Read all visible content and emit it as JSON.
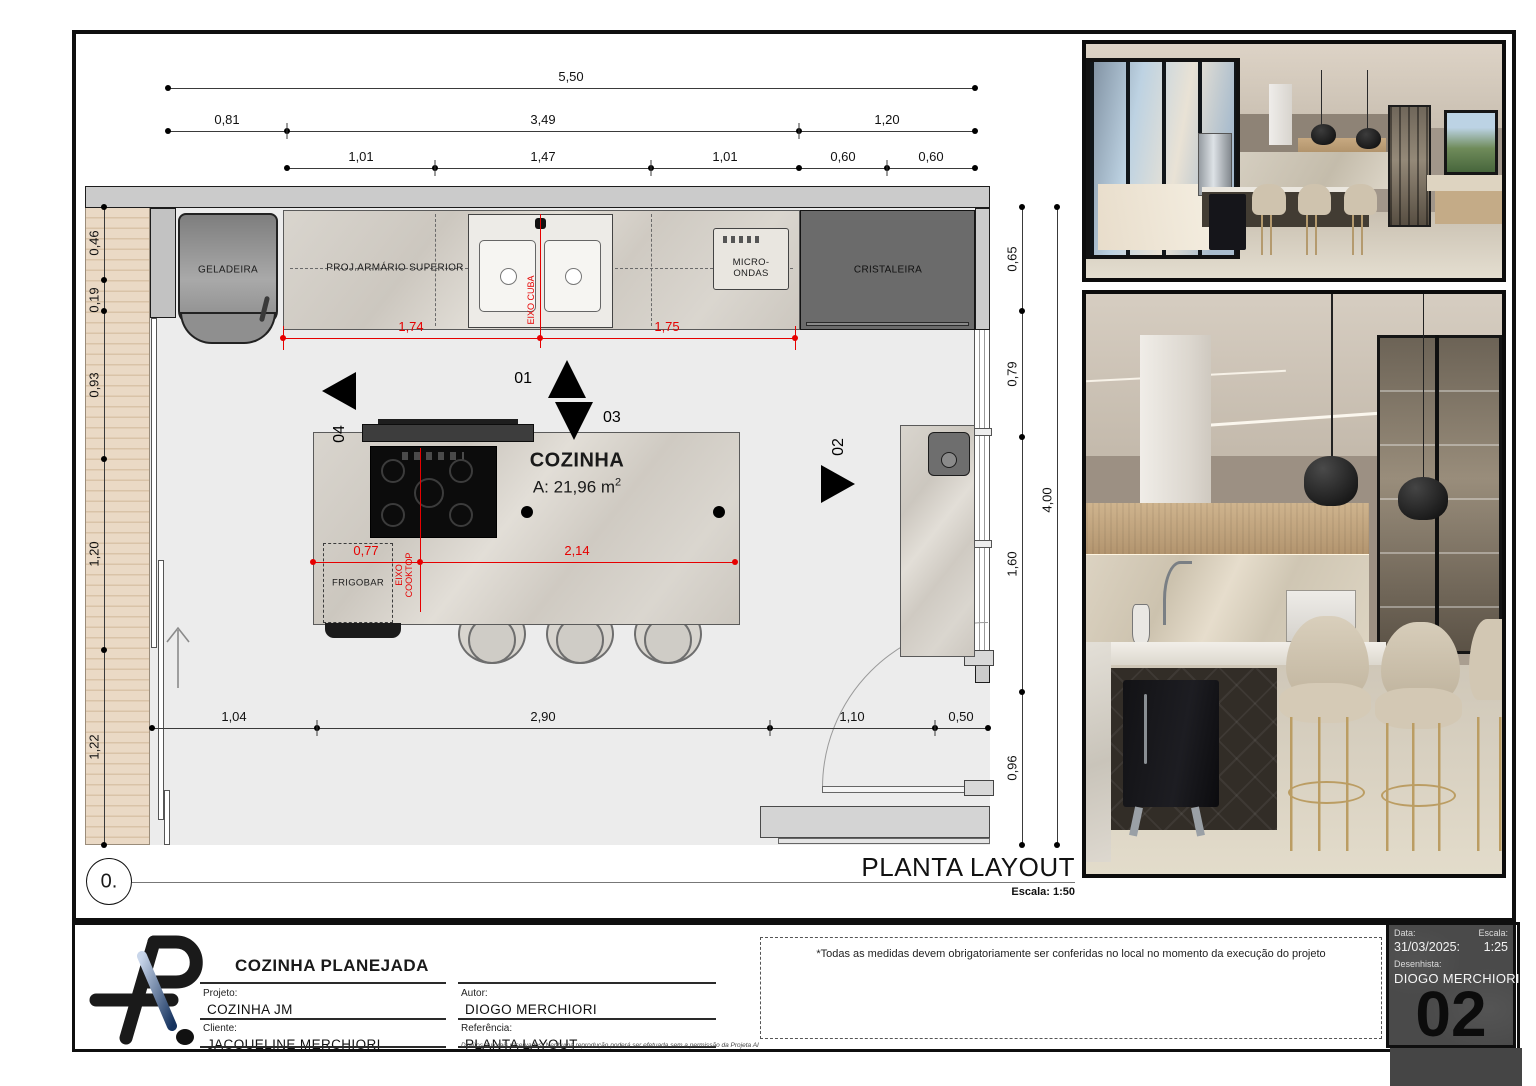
{
  "colors": {
    "dimension_red": "#e60000",
    "deck_tan": "#ead9c5",
    "info_gray": "#4a4a4a"
  },
  "plan": {
    "title": "PLANTA LAYOUT",
    "scale": "Escala: 1:50",
    "marker": "0.",
    "room": {
      "name": "COZINHA",
      "area": "A: 21,96 m",
      "area_sup": "2"
    },
    "labels": {
      "geladeira": "GELADEIRA",
      "armario_superior": "PROJ.ARMÁRIO SUPERIOR",
      "micro_ondas": "MICRO-ONDAS",
      "cristaleira": "CRISTALEIRA",
      "frigobar": "FRIGOBAR"
    },
    "axes": {
      "cuba": "EIXO CUBA",
      "cooktop": "EIXO COOKTOP"
    },
    "views": {
      "up": "01",
      "down": "03",
      "left": "04",
      "right": "02"
    },
    "dims": {
      "top_total": "5,50",
      "top_mid": [
        "0,81",
        "3,49",
        "1,20"
      ],
      "top_inner": [
        "1,01",
        "1,47",
        "1,01",
        "0,60",
        "0,60"
      ],
      "left": [
        "0,46",
        "0,19",
        "0,93",
        "1,20",
        "1,22"
      ],
      "right": [
        "0,65",
        "0,79",
        "1,60",
        "0,96"
      ],
      "right_total": "4,00",
      "bottom": [
        "1,04",
        "2,90",
        "1,10",
        "0,50"
      ],
      "red_top": [
        "1,74",
        "1,75"
      ],
      "red_island": [
        "0,77",
        "2,14"
      ]
    }
  },
  "note": "*Todas as medidas devem obrigatoriamente ser conferidas no local no momento da execução do projeto",
  "title_block": {
    "company_title": "COZINHA PLANEJADA",
    "projeto_label": "Projeto:",
    "projeto": "COZINHA JM",
    "cliente_label": "Cliente:",
    "cliente": "JACQUELINE  MERCHIORI",
    "autor_label": "Autor:",
    "autor": "DIOGO MERCHIORI",
    "referencia_label": "Referência:",
    "referencia": "PLANTA LAYOUT",
    "copyright": "Direitos autorais reservados. Nenhuma reprodução poderá ser efetuada sem a permissão da Projeta AI"
  },
  "info_block": {
    "data_label": "Data:",
    "data": "31/03/2025:",
    "escala_label": "Escala:",
    "escala": "1:25",
    "desenhista_label": "Desenhista:",
    "desenhista": "DIOGO MERCHIORI",
    "sheet_number": "02"
  }
}
